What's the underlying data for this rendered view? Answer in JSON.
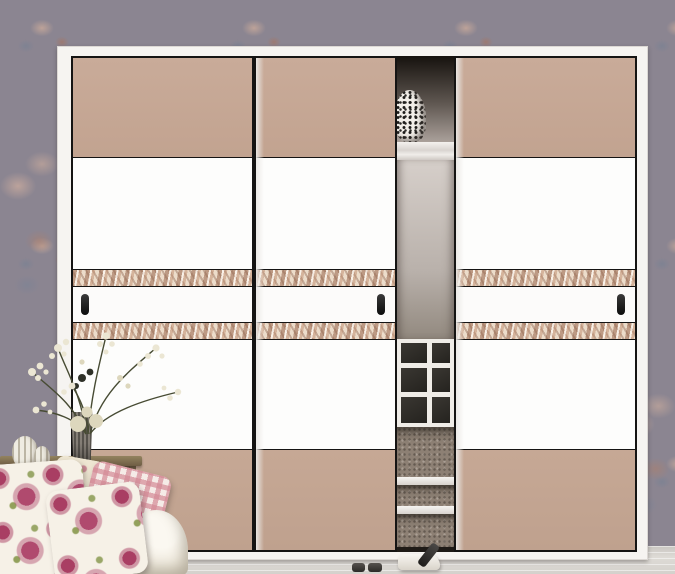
{
  "scene": {
    "type": "product-photo",
    "subject": "three-door sliding wardrobe in a bedroom corner",
    "objects": [
      {
        "name": "wallpaper",
        "detail": "gray-mauve floral rose pattern"
      },
      {
        "name": "wardrobe-frame",
        "detail": "white outer frame"
      },
      {
        "name": "sliding-door-left",
        "detail": "tan top and bottom panels, white middle, two woven decor strips, black handle on left"
      },
      {
        "name": "sliding-door-center",
        "detail": "same paneling, black handle on right"
      },
      {
        "name": "sliding-door-right",
        "detail": "same paneling, black handle on right"
      },
      {
        "name": "interior-gap",
        "detail": "open interior showing top shelf, spotted hat, back panel, shoe cubbies and two lower shelves"
      },
      {
        "name": "spotted-hat",
        "detail": "white item with black spots on top shelf"
      },
      {
        "name": "cabinet",
        "detail": "wooden console at lower left"
      },
      {
        "name": "vase",
        "detail": "ribbed gray cylinder vase"
      },
      {
        "name": "bouquet",
        "detail": "cream baby's-breath style flower sprays with dark stems"
      },
      {
        "name": "gourd-ornaments",
        "detail": "two small white ribbed ornaments"
      },
      {
        "name": "pillow-floral-1",
        "detail": "white pillow with magenta rose print"
      },
      {
        "name": "pillow-floral-2",
        "detail": "white pillow with larger magenta rose print"
      },
      {
        "name": "pillow-gingham",
        "detail": "pink checkered pillow"
      },
      {
        "name": "pillow-back",
        "detail": "small beige floral pillow"
      },
      {
        "name": "sofa-arm",
        "detail": "white rolled sofa arm"
      },
      {
        "name": "sofa-seat",
        "detail": "white sofa seat corner"
      },
      {
        "name": "slippers",
        "detail": "white slipper with dark strap and two small dark items on floor"
      },
      {
        "name": "floor",
        "detail": "light gray wood floor"
      }
    ]
  },
  "palette": {
    "wallpaper_base": "#8b8591",
    "wallpaper_rose": "#c6a89a",
    "wallpaper_leaf": "#74808e",
    "door_tan": "#c4a695",
    "door_white": "#fdfdfc",
    "door_border": "#151413",
    "decor_strip_base": "#ecdcca",
    "decor_strip_stroke": "#96644b",
    "frame_white": "#f6f4f1",
    "handle_black": "#0c0c0c",
    "interior_dark": "#16120e",
    "interior_back": "#b9b1ab",
    "cubby_cell": "#2b2925",
    "speckle": "#8d8074",
    "floor_gray": "#d8d5d1",
    "pillow_rose": "#a93e63",
    "gingham_pink": "#d48a96",
    "wood": "#6e5d44",
    "blossom_cream": "#ebe6d3"
  }
}
